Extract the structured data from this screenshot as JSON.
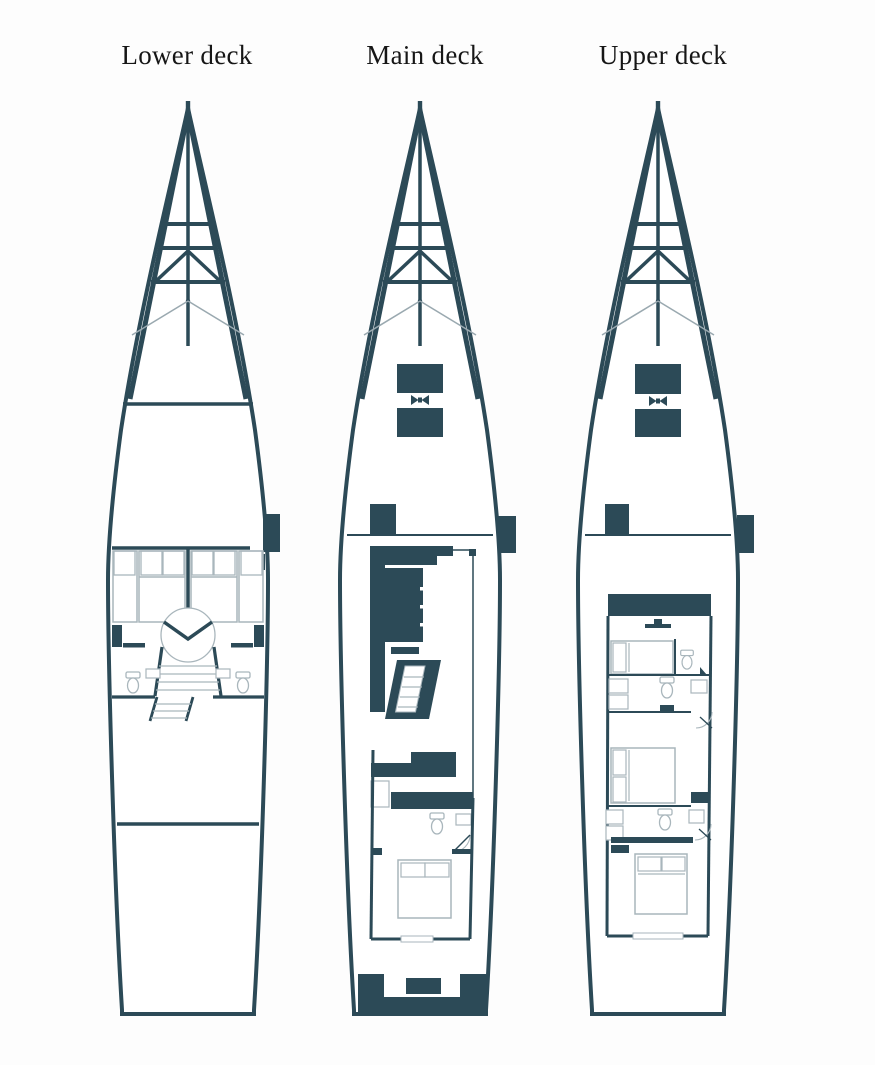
{
  "page": {
    "background": "#fdfdfd"
  },
  "colors": {
    "ink": "#2c4a57",
    "furniture": "#a9b6bc",
    "lifeline": "#9aa9b0",
    "label": "#161616",
    "page_bg": "#fdfdfd"
  },
  "decks": [
    {
      "label": "Lower deck"
    },
    {
      "label": "Main deck"
    },
    {
      "label": "Upper deck"
    }
  ],
  "icons": {
    "winch": "winch-cleat-icon",
    "toilet": "toilet-icon",
    "mast": "mast-rigging-icon"
  }
}
